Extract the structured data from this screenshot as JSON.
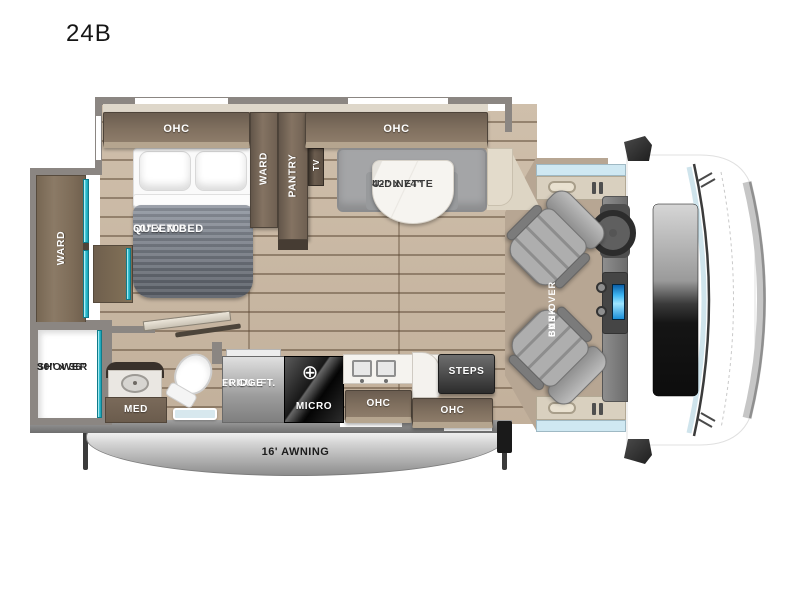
{
  "title": "24B",
  "colors": {
    "accent_teal": "#2fc1d3",
    "cabinet_wood": "#7b6a5a",
    "floor_wood": "#c9b8a4",
    "wall_gray": "#8b8682",
    "mattress_gray": "#6a6e75",
    "console_screen_blue": "#3db5f2",
    "awning_silver": "#b5b5b5"
  },
  "labels": {
    "bed_ohc": "OHC",
    "ward_top": "WARD",
    "pantry": "PANTRY",
    "tv": "TV",
    "dinette_ohc": "OHC",
    "queen_bed_size": "60\" x 70\"",
    "queen_bed_name": "QUEEN BED",
    "dinette_size": "42\" x 74\"",
    "dinette_name": "U-DINETTE",
    "ward_slide": "WARD",
    "shower_size": "30\" x 36\"",
    "shower_name": "SHOWER",
    "med": "MED",
    "fridge_line1": "10 CU. FT.",
    "fridge_line2": "FRIDGE",
    "micro": "MICRO",
    "burner_icon": "⊕",
    "kitchen_ohc_left": "OHC",
    "kitchen_ohc_right": "OHC",
    "steps": "STEPS",
    "cab_over_line1": "CAB-OVER",
    "cab_over_line2": "BUNK",
    "awning": "16' AWNING"
  }
}
